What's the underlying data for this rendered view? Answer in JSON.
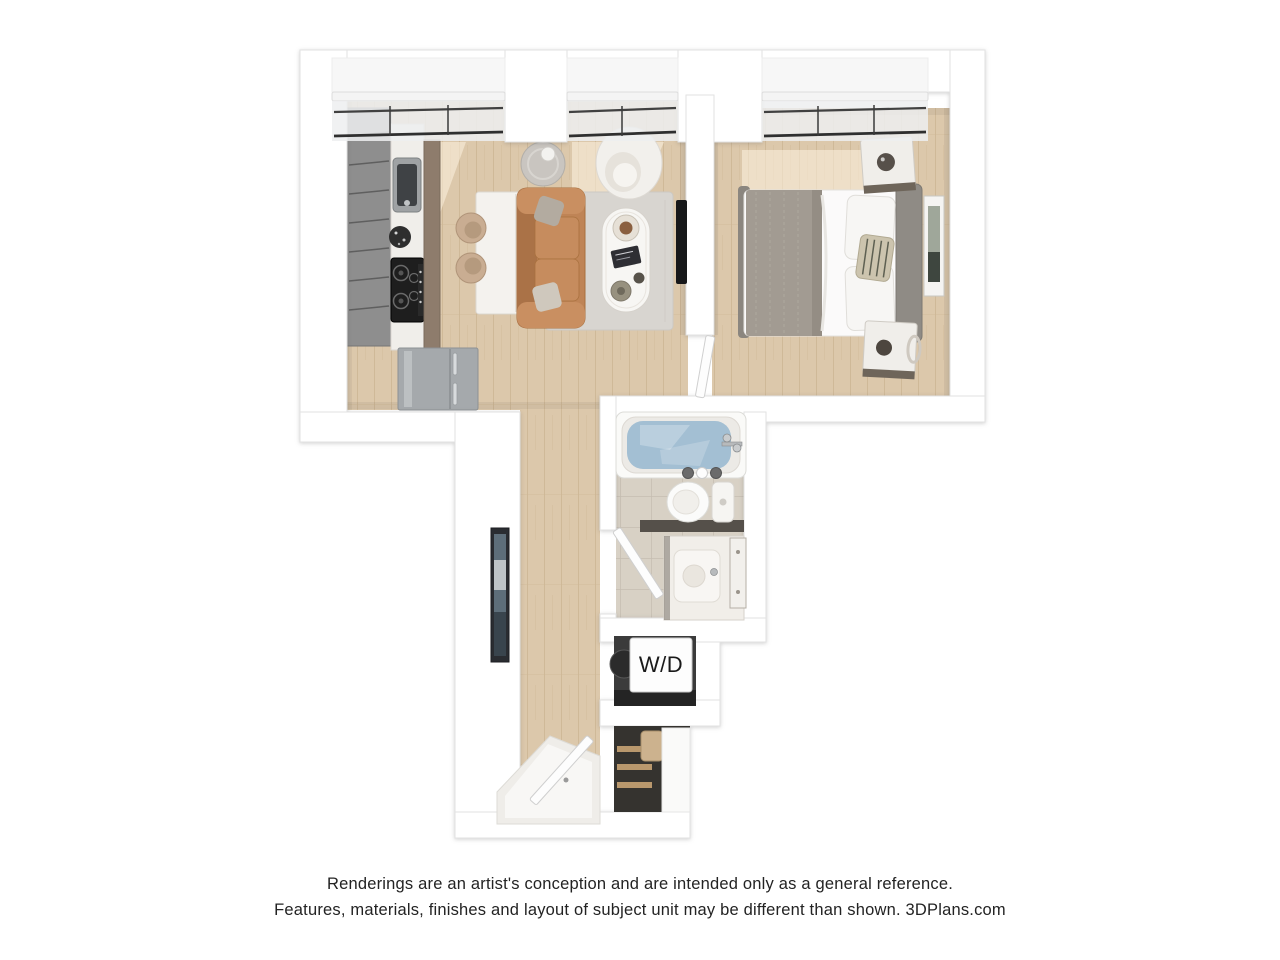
{
  "scene": {
    "type": "3d-floor-plan-rendering",
    "rooms": [
      "kitchen",
      "living-area",
      "bedroom",
      "bathroom",
      "washer-dryer-closet",
      "closet",
      "entry-hall"
    ],
    "depicted_items": [
      "kitchen cabinets with sink and cooktop",
      "refrigerator",
      "kitchen island with two stools",
      "tan sofa with pillows",
      "area rug",
      "oval coffee table",
      "white armchair",
      "side table with lamp",
      "wall-mounted tv",
      "bed with gray throw and pillows",
      "two marble-top nightstands",
      "wall art",
      "bathtub filled with water",
      "toilet",
      "vanity with sink",
      "stacked washer dryer",
      "closet shelves with garment bag",
      "open entry door",
      "three windows with roller shades"
    ]
  },
  "labels": {
    "washer_dryer": "W/D"
  },
  "disclaimer": {
    "line1": "Renderings are an artist's conception and are intended only as a general reference.",
    "line2": "Features, materials, finishes and layout of subject unit may be different than shown. 3DPlans.com",
    "brand": "3DPlans.com"
  },
  "palette": {
    "background": "#ffffff",
    "wall": "#ffffff",
    "wall_edge": "#e2e2e2",
    "wood_floor": "#dcc8ab",
    "wood_plank_line": "#c8b08d",
    "sunlight_patch": "#fdf3e0",
    "rug": "#d8d5d0",
    "sofa": "#bf8456",
    "pillow_gray": "#b3aba0",
    "armchair": "#f2f0ec",
    "coffee_table": "#f7f6f3",
    "kitchen_cabinet": "#8e8e8e",
    "kitchen_counter": "#f0eeea",
    "cabinet_bronze": "#8e7c6c",
    "cooktop": "#1e1e1e",
    "refrigerator": "#a5a9ac",
    "island": "#f4f2ee",
    "stool_tan": "#c9ad92",
    "bed_duvet": "#fbfafa",
    "bed_blanket": "#a29b92",
    "headboard": "#8f8b85",
    "nightstand_marble": "#f0eeea",
    "nightstand_wood": "#6e655a",
    "tub_water": "#a3bfd3",
    "bathroom_tile": "#d8d1c5",
    "tile_grout": "#c5bdb1",
    "fixture_white": "#fafaf8",
    "closet_shelf_wood": "#b9986d",
    "garment_bag": "#ccb28e",
    "art_frame_dark": "#2a2c31",
    "tv_black": "#17181a",
    "disclaimer_text": "#232323"
  }
}
